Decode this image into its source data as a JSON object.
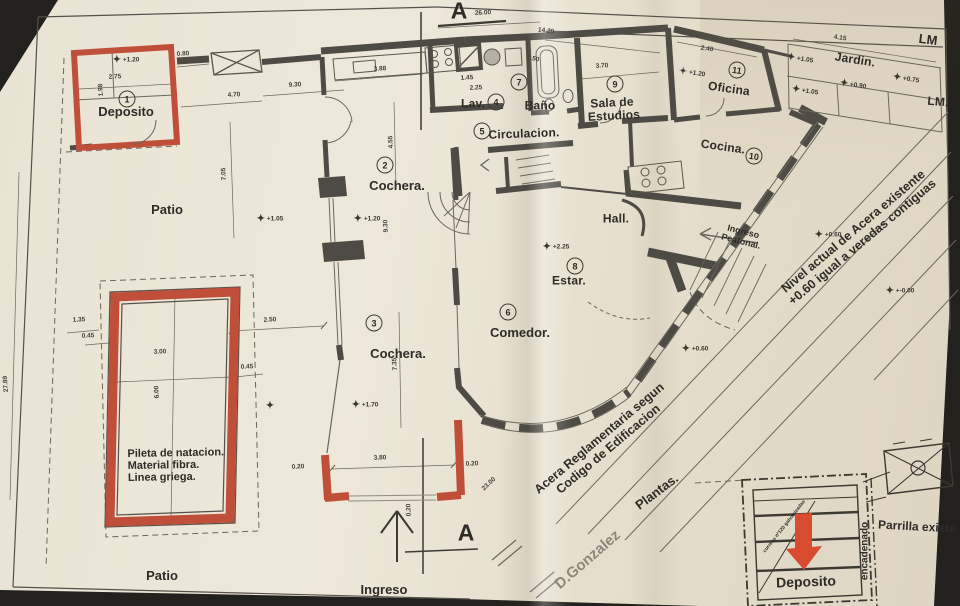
{
  "section_marks": {
    "top": "A",
    "bottom": "A"
  },
  "rooms": [
    {
      "num": "1",
      "label": "Deposito"
    },
    {
      "num": "2",
      "label": "Cochera."
    },
    {
      "num": "3",
      "label": "Cochera."
    },
    {
      "num": "4",
      "label": "Lav."
    },
    {
      "num": "5",
      "label": "Circulacion."
    },
    {
      "num": "6",
      "label": "Comedor."
    },
    {
      "num": "7",
      "label": "Baño"
    },
    {
      "num": "8",
      "label": "Estar."
    },
    {
      "num": "9",
      "label": "Sala de",
      "label2": "Estudios"
    },
    {
      "num": "10",
      "label": "Cocina."
    },
    {
      "num": "11",
      "label": "Oficina"
    }
  ],
  "labels": {
    "patio_top": "Patio",
    "patio_bottom": "Patio",
    "ingreso": "Ingreso",
    "hall": "Hall.",
    "jardin": "Jardin.",
    "lm_top": "LM",
    "lm_right": "LM."
  },
  "pool": {
    "l1": "Pileta de natacion.",
    "l2": "Material fibra.",
    "l3": "Linea griega."
  },
  "annotations": {
    "nivel1": "Nivel actual de Acera existente",
    "nivel2": "+0.60 igual a veredas contiguas",
    "acera1": "Acera Reglamentaria segun",
    "acera2": "Codigo de Edificacion",
    "plantas": "Plantas.",
    "street": "D.Gonzalez",
    "ingresop1": "Ingreso",
    "ingresop2": "Peatonal.",
    "legend_deposito": "Deposito",
    "parrilla": "Parrilla existe",
    "encadenado": "encadenado",
    "legend_note": "correas nº120 galvanizadas"
  },
  "levels": [
    {
      "v": "+1.20"
    },
    {
      "v": "+1.05"
    },
    {
      "v": "+1.20"
    },
    {
      "v": "+1.70"
    },
    {
      "v": "+2.25"
    },
    {
      "v": "+1.20"
    },
    {
      "v": "+1.05"
    },
    {
      "v": "+1.05"
    },
    {
      "v": "+0.90"
    },
    {
      "v": "+0.75"
    },
    {
      "v": "+0.60"
    },
    {
      "v": "+0.60"
    },
    {
      "v": "+-0.00"
    },
    {
      "v": ""
    }
  ],
  "dims": [
    "26.00",
    "14.20",
    "0.80",
    "2.75",
    "1.98",
    "4.70",
    "9.30",
    "3.88",
    "4.55",
    "1.45",
    "2.25",
    "1.50",
    "3.70",
    "2.40",
    "4.15",
    "7.05",
    "2.50",
    "9.30",
    "7.35",
    "1.35",
    "0.45",
    "3.00",
    "6.00",
    "0.45",
    "3.80",
    "0.20",
    "0.20",
    "0.20",
    "23.00",
    "27.89"
  ],
  "colors": {
    "paper": "#e9e3d4",
    "wall": "#4e4b45",
    "red": "#c04f3a",
    "arrow": "#d84b2e"
  }
}
